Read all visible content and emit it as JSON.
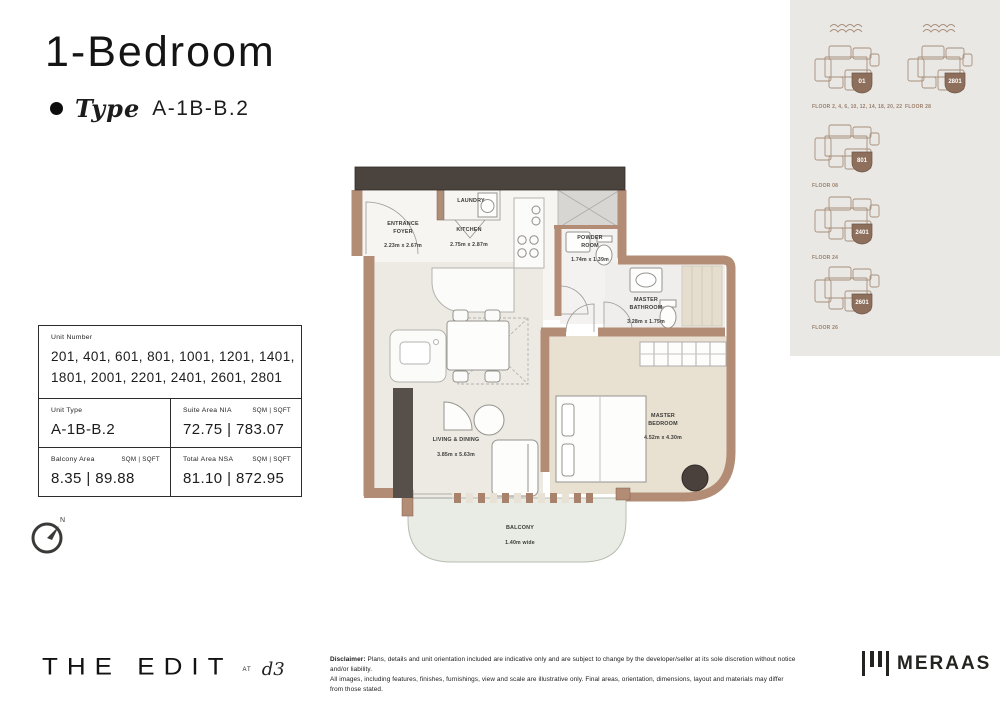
{
  "header": {
    "title": "1-Bedroom",
    "type_label": "Type",
    "type_value": "A-1B-B.2"
  },
  "key_plans": [
    {
      "floor_label": "FLOOR 2, 4, 6, 10, 12, 14, 18, 20, 22",
      "unit": "01"
    },
    {
      "floor_label": "FLOOR 28",
      "unit": "2801"
    },
    {
      "floor_label": "FLOOR 08",
      "unit": "801"
    },
    {
      "floor_label": "FLOOR 24",
      "unit": "2401"
    },
    {
      "floor_label": "FLOOR 26",
      "unit": "2601"
    }
  ],
  "info_table": {
    "unit_number_label": "Unit Number",
    "unit_numbers": "201, 401, 601, 801, 1001, 1201, 1401, 1801, 2001, 2201, 2401, 2601, 2801",
    "unit_type_label": "Unit Type",
    "unit_type": "A-1B-B.2",
    "units_label": "SQM | SQFT",
    "suite_area_label": "Suite Area NIA",
    "suite_area": "72.75 | 783.07",
    "balcony_area_label": "Balcony Area",
    "balcony_area": "8.35 | 89.88",
    "total_area_label": "Total Area NSA",
    "total_area": "81.10 | 872.95"
  },
  "floor_plan": {
    "compass_label": "N",
    "rooms": {
      "laundry": {
        "name": "LAUNDRY",
        "dims": ""
      },
      "entrance_foyer": {
        "name": "ENTRANCE\nFOYER",
        "dims": "2.23m x 2.67m"
      },
      "kitchen": {
        "name": "KITCHEN",
        "dims": "2.75m x 2.87m"
      },
      "powder_room": {
        "name": "POWDER\nROOM",
        "dims": "1.74m x 1.39m"
      },
      "master_bathroom": {
        "name": "MASTER\nBATHROOM",
        "dims": "3.28m x 1.75m"
      },
      "living_dining": {
        "name": "LIVING & DINING",
        "dims": "3.85m x 5.63m"
      },
      "master_bedroom": {
        "name": "MASTER\nBEDROOM",
        "dims": "4.52m x 4.30m"
      },
      "balcony": {
        "name": "BALCONY",
        "dims": "1.40m wide"
      }
    }
  },
  "footer": {
    "brand": "THE EDIT",
    "at_label": "AT",
    "d3_label": "d3",
    "disclaimer_label": "Disclaimer:",
    "disclaimer_line1": "Plans, details and unit orientation included are indicative only and are subject to change by the developer/seller at its sole discretion without notice and/or liability.",
    "disclaimer_line2": "All images, including features, finishes, furnishings, view and scale are illustrative only. Final areas, orientation, dimensions, layout and materials may differ from those stated.",
    "meraas_label": "MERAAS"
  },
  "colors": {
    "wall_brown": "#b38c75",
    "dark_wall": "#4b433d",
    "badge_brown": "#8d6f5c",
    "key_plan_line": "#a8907c",
    "panel_bg": "#e9e8e5"
  }
}
